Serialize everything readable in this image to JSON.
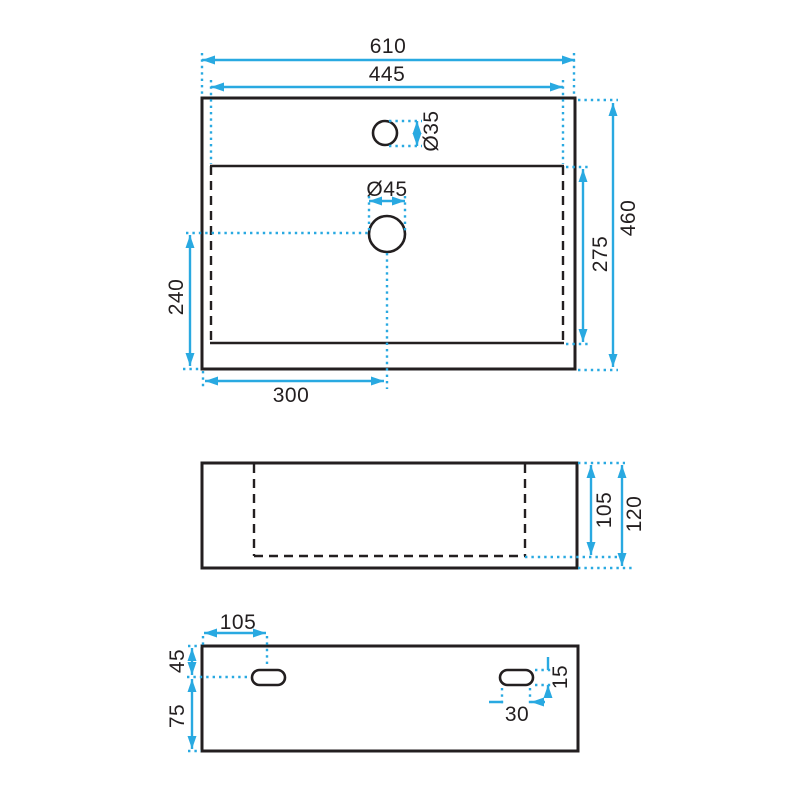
{
  "drawing": {
    "views": {
      "top_view": "washbasin plan view",
      "front_view": "washbasin front elevation",
      "bottom_view": "washbasin underside view"
    }
  },
  "dimensions": {
    "top_view": {
      "overall_width": "610",
      "inner_width": "445",
      "faucet_hole_dia": "Ø35",
      "drain_hole_dia": "Ø45",
      "overall_depth": "460",
      "inner_depth": "275",
      "drain_offset_bottom": "240",
      "drain_offset_left": "300"
    },
    "front_view": {
      "basin_inner_height": "105",
      "overall_height": "120"
    },
    "bottom_view": {
      "slot_offset_left": "105",
      "slot_offset_top": "45",
      "slot_offset_bottom": "75",
      "slot_width": "30",
      "slot_height": "15"
    }
  },
  "colors": {
    "dimension_lines": "#29a9e1",
    "outline": "#231f20",
    "background": "#ffffff"
  }
}
